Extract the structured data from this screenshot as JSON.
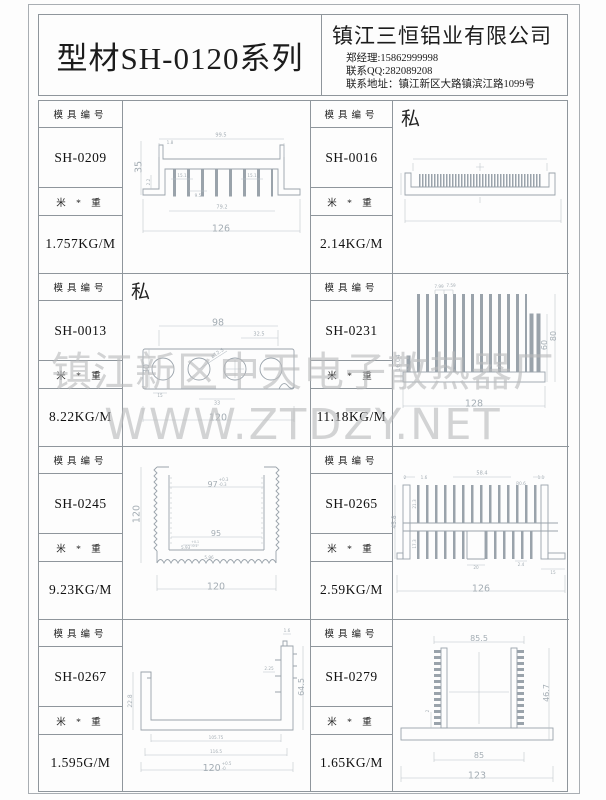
{
  "header": {
    "series_title": "型材SH-0120系列",
    "company_name": "镇江三恒铝业有限公司",
    "contact_manager": "郑经理:15862999998",
    "contact_qq": "联系QQ:282089208",
    "contact_address": "联系地址：镇江新区大路镇滨江路1099号"
  },
  "labels": {
    "mold_no": "模具编号",
    "meter_weight": "米 * 重",
    "private": "私"
  },
  "watermark": {
    "line1": "镇江新区中天电子散热器厂",
    "line2": "WWW.ZTDZY.NET"
  },
  "cells": [
    {
      "model": "SH-0209",
      "weight": "1.757KG/M",
      "private": false,
      "dims": [
        "99.5",
        "1.8",
        "35",
        "2.2",
        "15.1",
        "15.1",
        "9.5",
        "79.2",
        "126"
      ]
    },
    {
      "model": "SH-0016",
      "weight": "2.14KG/M",
      "private": true,
      "dims": []
    },
    {
      "model": "SH-0013",
      "weight": "8.22KG/M",
      "private": true,
      "dims": [
        "98",
        "32.5",
        "30",
        "ø12.5",
        "15",
        "33",
        "120"
      ]
    },
    {
      "model": "SH-0231",
      "weight": "11.18KG/M",
      "private": false,
      "dims": [
        "7.99",
        "7.59",
        "16.04",
        "60",
        "80",
        "128"
      ]
    },
    {
      "model": "SH-0245",
      "weight": "9.23KG/M",
      "private": false,
      "dims": [
        "97",
        "+0.3",
        "-0.3",
        "120",
        "95",
        "5.93",
        "+0.1",
        "-0.1",
        "5.96",
        "120"
      ]
    },
    {
      "model": "SH-0265",
      "weight": "2.59KG/M",
      "private": false,
      "dims": [
        "2",
        "1.6",
        "58.4",
        "R0.6",
        "1.1",
        "45.8",
        "21.3",
        "17.3",
        "20",
        "2.4",
        "15",
        "126"
      ]
    },
    {
      "model": "SH-0267",
      "weight": "1.595G/M",
      "private": false,
      "dims": [
        "22.8",
        "64.5",
        "1.6",
        "2.25",
        "105.75",
        "116.5",
        "120",
        "+0.5",
        "-0"
      ]
    },
    {
      "model": "SH-0279",
      "weight": "1.65KG/M",
      "private": false,
      "dims": [
        "85.5",
        "46.7",
        "2",
        "85",
        "123"
      ]
    }
  ]
}
